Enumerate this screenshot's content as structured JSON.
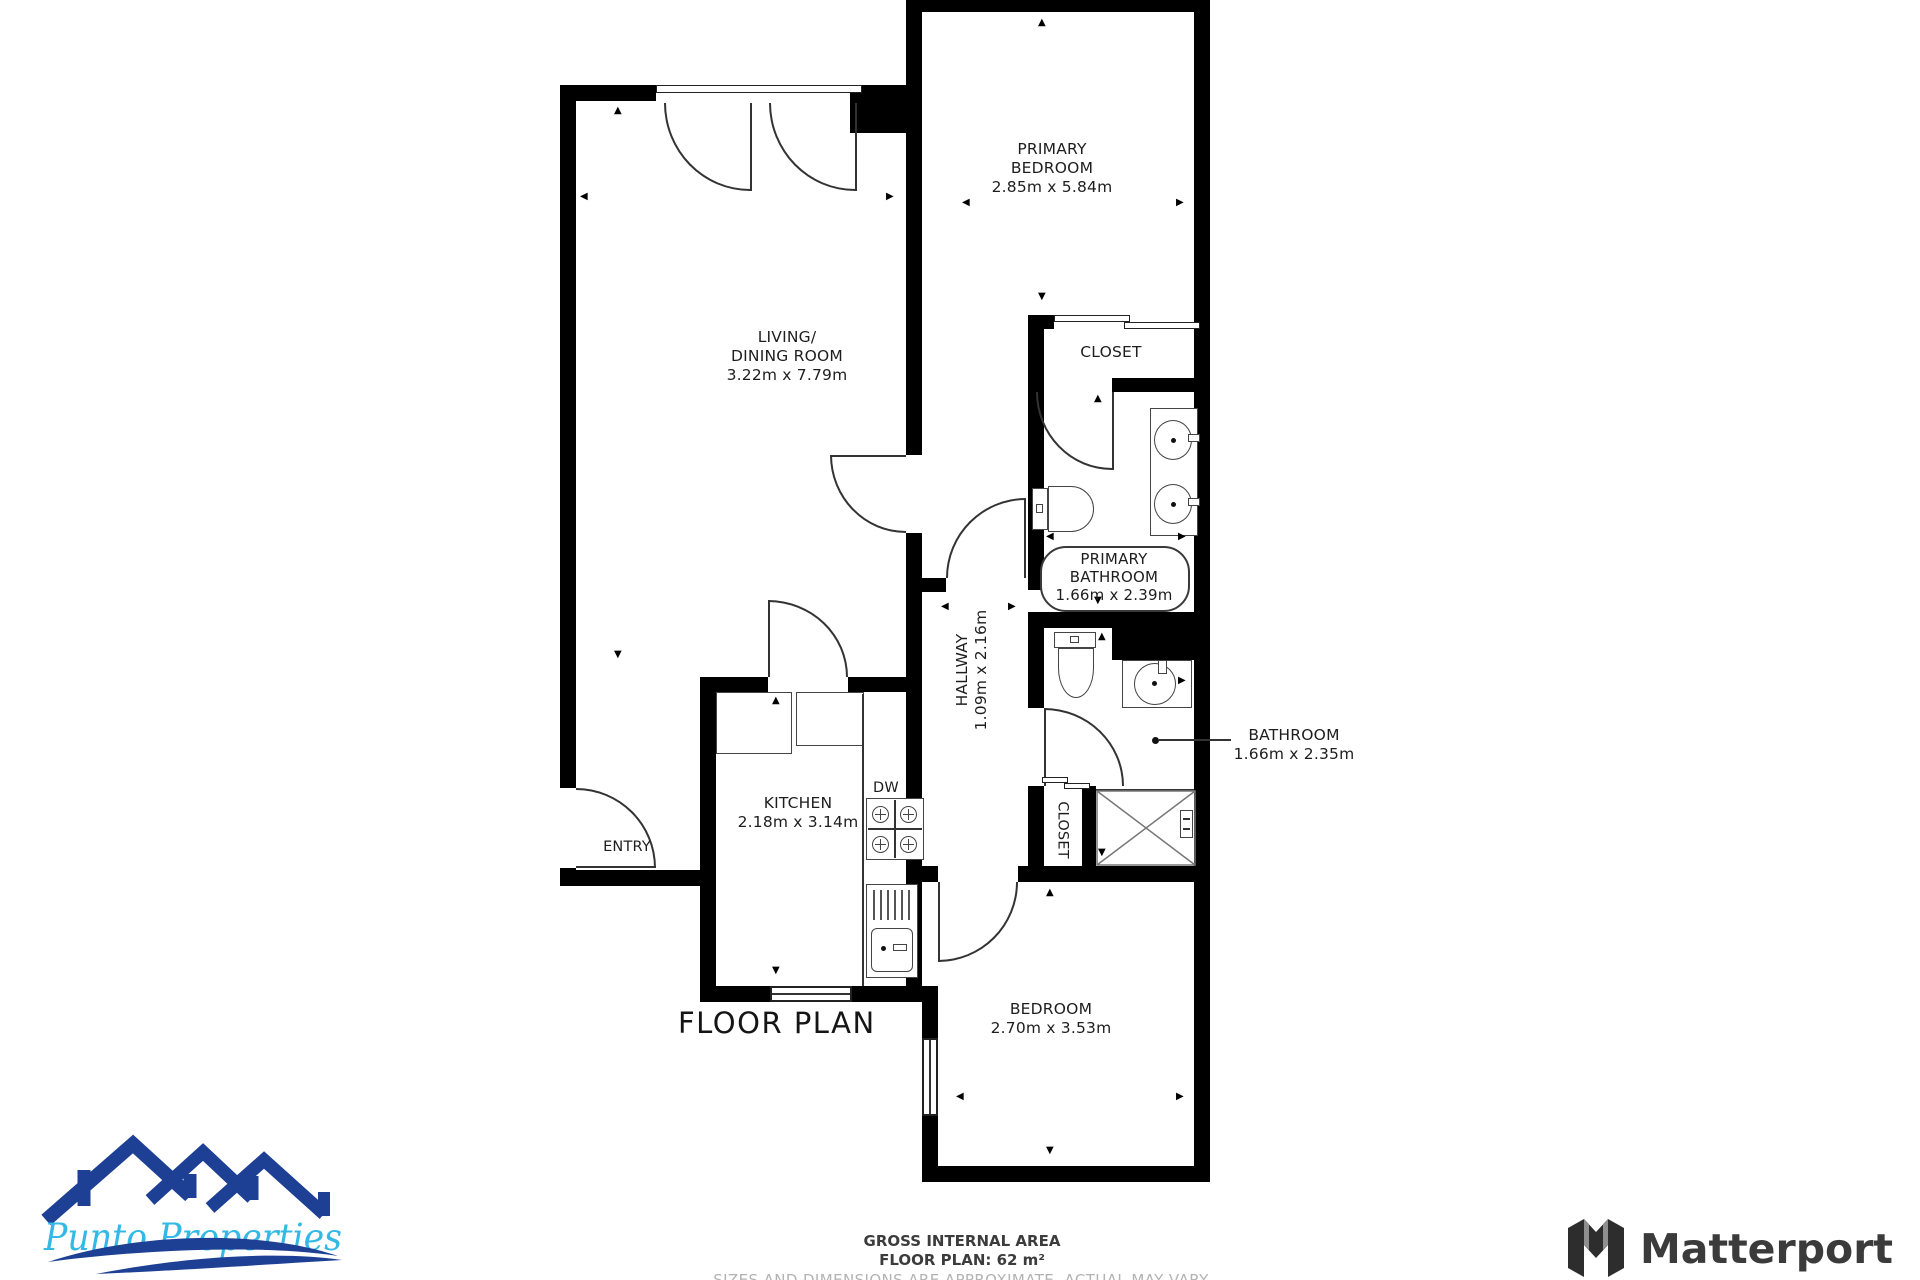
{
  "plan": {
    "title": "FLOOR PLAN",
    "rooms": {
      "living": {
        "line1": "LIVING/",
        "line2": "DINING ROOM",
        "dims": "3.22m x 7.79m"
      },
      "primary_bedroom": {
        "line1": "PRIMARY",
        "line2": "BEDROOM",
        "dims": "2.85m x 5.84m"
      },
      "closet_upper": {
        "label": "CLOSET"
      },
      "primary_bathroom": {
        "line1": "PRIMARY",
        "line2": "BATHROOM",
        "dims": "1.66m x 2.39m"
      },
      "hallway": {
        "label": "HALLWAY",
        "dims": "1.09m x 2.16m"
      },
      "bathroom": {
        "label": "BATHROOM",
        "dims": "1.66m x 2.35m"
      },
      "kitchen": {
        "label": "KITCHEN",
        "dims": "2.18m x 3.14m"
      },
      "dishwasher": {
        "label": "DW"
      },
      "entry": {
        "label": "ENTRY"
      },
      "closet_lower": {
        "label": "CLOSET"
      },
      "bedroom": {
        "label": "BEDROOM",
        "dims": "2.70m x 3.53m"
      }
    },
    "footer": {
      "line1": "GROSS INTERNAL AREA",
      "line2": "FLOOR PLAN: 62 m²",
      "line3": "SIZES AND DIMENSIONS ARE APPROXIMATE, ACTUAL MAY VARY."
    }
  },
  "branding": {
    "agency": "Punto Properties",
    "provider": "Matterport"
  },
  "icons": {
    "dim_arrow_up": "▲",
    "dim_arrow_down": "▼",
    "dim_arrow_left": "◀",
    "dim_arrow_right": "▶"
  },
  "colors": {
    "wall": "#000000",
    "door_line": "#333333",
    "fixture_line": "#444444",
    "logo_navy": "#1d3f94",
    "logo_cyan": "#33b9e6",
    "matterport_text": "#3b3b3b",
    "footer_muted": "#b3b3b3"
  }
}
